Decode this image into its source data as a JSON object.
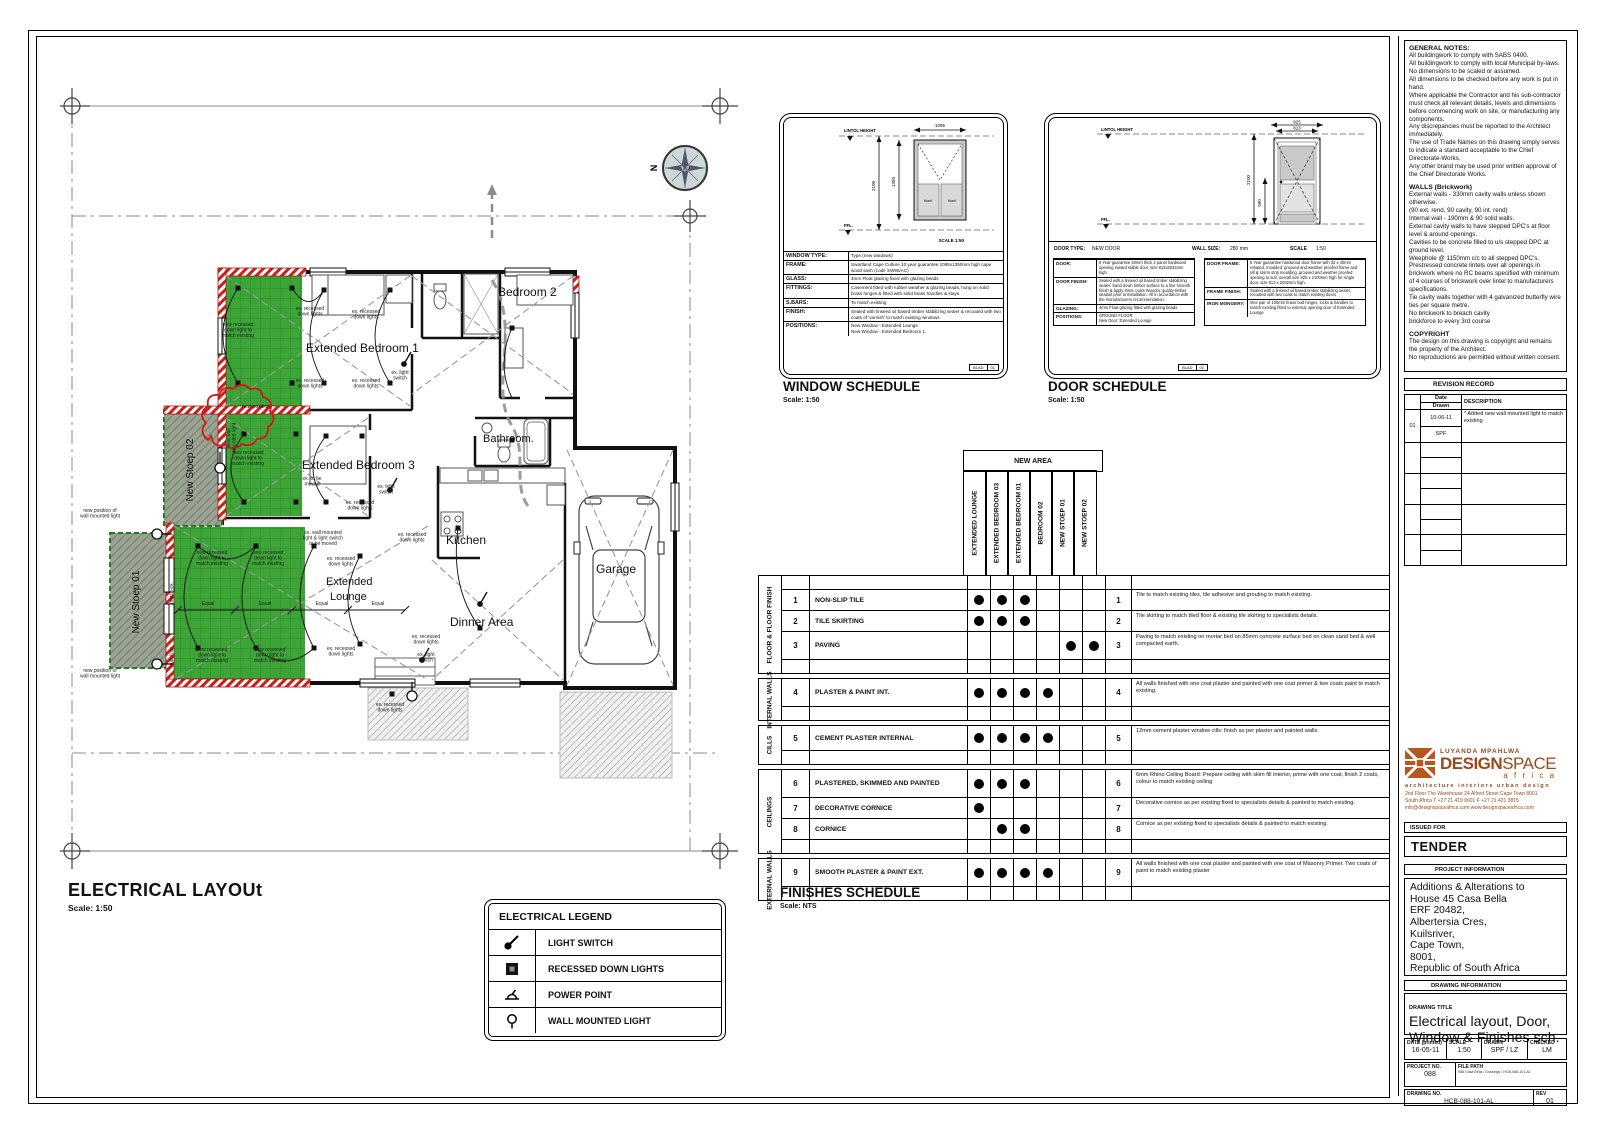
{
  "colors": {
    "accent_green": "#3da438",
    "revision_red": "#d41717",
    "wall_red_hatch": "#c9201d",
    "logo_orange": "#9c4a1a",
    "compass_fill": "#ccd9d8"
  },
  "plan": {
    "title": "ELECTRICAL LAYOUt",
    "scale": "Scale: 1:50",
    "compass_label": "N",
    "rooms": [
      {
        "x": 246,
        "y": 264,
        "t": "Extended Bedroom 1",
        "s": 12
      },
      {
        "x": 438,
        "y": 208,
        "t": "Bedroom 2",
        "s": 12
      },
      {
        "x": 242,
        "y": 381,
        "t": "Extended Bedroom 3",
        "s": 12
      },
      {
        "x": 423,
        "y": 354,
        "t": "Bathroom.",
        "s": 11
      },
      {
        "x": 386,
        "y": 456,
        "t": "Kitchen",
        "s": 12
      },
      {
        "x": 266,
        "y": 497,
        "t": "Extended",
        "s": 11
      },
      {
        "x": 270,
        "y": 512,
        "t": "Lounge",
        "s": 11
      },
      {
        "x": 390,
        "y": 538,
        "t": "Dinner Area",
        "s": 12
      },
      {
        "x": 536,
        "y": 485,
        "t": "Garage",
        "s": 12
      },
      {
        "x": 133,
        "y": 382,
        "t": "New Stoep 02",
        "s": 10,
        "r": -90,
        "a": "middle"
      },
      {
        "x": 79,
        "y": 514,
        "t": "New Stoep 01",
        "s": 10,
        "r": -90,
        "a": "middle"
      }
    ],
    "annotations": [
      {
        "x": 250,
        "y": 222,
        "lines": [
          "ex. recessed",
          "down lights"
        ]
      },
      {
        "x": 306,
        "y": 225,
        "lines": [
          "ex. recessed",
          "down lights"
        ]
      },
      {
        "x": 250,
        "y": 294,
        "lines": [
          "ex. recessed",
          "down lights"
        ]
      },
      {
        "x": 306,
        "y": 294,
        "lines": [
          "ex. recessed",
          "down lights"
        ]
      },
      {
        "x": 340,
        "y": 286,
        "lines": [
          "ex. light",
          "switch"
        ]
      },
      {
        "x": 178,
        "y": 238,
        "lines": [
          "new recessed",
          "down light to",
          "match existing"
        ]
      },
      {
        "x": 188,
        "y": 366,
        "lines": [
          "new recessed",
          "down light to",
          "match existing"
        ]
      },
      {
        "x": 196,
        "y": 320,
        "lines": [
          "new position"
        ]
      },
      {
        "x": 252,
        "y": 392,
        "lines": [
          "ex. to be",
          "moved"
        ]
      },
      {
        "x": 300,
        "y": 416,
        "lines": [
          "ex. recessed",
          "down lights"
        ]
      },
      {
        "x": 326,
        "y": 400,
        "lines": [
          "ex. light",
          "switch"
        ]
      },
      {
        "x": 152,
        "y": 466,
        "lines": [
          "new recessed",
          "down light to",
          "match existing"
        ]
      },
      {
        "x": 208,
        "y": 466,
        "lines": [
          "new recessed",
          "down light to",
          "match existing"
        ]
      },
      {
        "x": 152,
        "y": 563,
        "lines": [
          "new recessed",
          "down light to",
          "match existing"
        ]
      },
      {
        "x": 210,
        "y": 563,
        "lines": [
          "new recessed",
          "down light to",
          "match existing"
        ]
      },
      {
        "x": 281,
        "y": 472,
        "lines": [
          "ex. recessed",
          "down lights"
        ]
      },
      {
        "x": 281,
        "y": 562,
        "lines": [
          "ex. recessed",
          "down lights"
        ]
      },
      {
        "x": 263,
        "y": 446,
        "lines": [
          "ex. wall mounted",
          "light & light switch",
          "to be moved"
        ]
      },
      {
        "x": 40,
        "y": 424,
        "lines": [
          "new position of",
          "wall mounted light"
        ]
      },
      {
        "x": 40,
        "y": 584,
        "lines": [
          "new position of",
          "wall mounted light"
        ]
      },
      {
        "x": 352,
        "y": 448,
        "lines": [
          "ex. recessed",
          "down lights"
        ]
      },
      {
        "x": 366,
        "y": 550,
        "lines": [
          "ex. recessed",
          "down lights"
        ]
      },
      {
        "x": 366,
        "y": 568,
        "lines": [
          "ex. light",
          "switch"
        ]
      },
      {
        "x": 330,
        "y": 618,
        "lines": [
          "ex. recessed",
          "down lights"
        ]
      },
      {
        "x": 170,
        "y": 350,
        "r": -90,
        "lines": [
          "new wall",
          "mounted light"
        ]
      },
      {
        "x": 113,
        "y": 505,
        "r": -90,
        "lines": [
          "match ex."
        ]
      },
      {
        "x": 113,
        "y": 568,
        "r": -90,
        "lines": [
          "match ex."
        ]
      },
      {
        "x": 148,
        "y": 517,
        "lines": [
          "Equal"
        ]
      },
      {
        "x": 205,
        "y": 517,
        "lines": [
          "Equal"
        ]
      },
      {
        "x": 262,
        "y": 517,
        "lines": [
          "Equal"
        ]
      },
      {
        "x": 318,
        "y": 517,
        "lines": [
          "Equal"
        ]
      }
    ]
  },
  "legend": {
    "title": "ELECTRICAL LEGEND",
    "items": [
      {
        "icon": "light-switch-icon",
        "label": "LIGHT SWITCH"
      },
      {
        "icon": "recessed-downlight-icon",
        "label": "RECESSED DOWN LIGHTS"
      },
      {
        "icon": "power-point-icon",
        "label": "POWER POINT"
      },
      {
        "icon": "wall-mounted-light-icon",
        "label": "WALL MOUNTED LIGHT"
      }
    ]
  },
  "window_schedule": {
    "title": "WINDOW SCHEDULE",
    "scale": "Scale: 1:50",
    "lintol": "LINTOL HEIGHT",
    "ffl": "FFL.",
    "scale_inner": "SCALE  1:50",
    "fixed1": "fixed",
    "fixed2": "fixed",
    "dims": {
      "w": "1095",
      "h": "2100",
      "h2": "1350"
    },
    "rows": [
      {
        "label": "WINDOW TYPE:",
        "value": "Type (new windows)"
      },
      {
        "label": "FRAME:",
        "value": "Swartland Cape Culture 10 year guarantee 1095x1350mm high cape wood sash (code SW95/AC)"
      },
      {
        "label": "GLASS:",
        "value": "4mm Float glazing fixed with glazing beads"
      },
      {
        "label": "FITTINGS:",
        "value": "Casement fitted with rubber weather & glazing beads, hung on solid brass hinges & fitted with solid brass handles & stays."
      },
      {
        "label": "S.BARS:",
        "value": "To match existing"
      },
      {
        "label": "FINISH:",
        "value": "Sealed with linseed oil based timber stabilizing sealer & recoated with two coats of 'varnish' to match existing windows"
      },
      {
        "label": "POSITIONS:",
        "value": "New Window - Extended Lounge\nNew Window - Extended Bedroom 1."
      }
    ],
    "ref1": "BLAD",
    "ref2": "01"
  },
  "door_schedule": {
    "title": "DOOR SCHEDULE",
    "scale": "Scale: 1:50",
    "lintol": "LINTOL HEIGHT",
    "ffl": "FFL.",
    "dims": {
      "w1": "925",
      "w2": "813",
      "h": "2100",
      "h2": "990"
    },
    "head": {
      "type_label": "DOOR TYPE:",
      "type_value": "NEW DOOR",
      "wall_label": "WALL SIZE:",
      "wall_value": "280 mm",
      "scale_label": "SCALE",
      "scale_value": "1:50"
    },
    "left_rows": [
      {
        "label": "DOOR:",
        "value": "5 Year guarantee 40mm thick 2 panel hardwood opening inward stable door, size 813x2032mm high."
      },
      {
        "label": "DOOR FINISH:",
        "value": "Sealed with a linseed oil based timber stabilizing sealer. Sand down timber surface to a fine smooth finish & apply three coats Woodoc quality timber sealant prior to installation. All in accordance with the manufacturers recommendation."
      },
      {
        "label": "GLAZING:",
        "value": "4mm Float glazing fitted with glazing beads"
      },
      {
        "label": "POSITIONS:",
        "value": "GROUND FLOOR:\nNew Door: Extended Lounge"
      }
    ],
    "right_rows": [
      {
        "label": "DOOR FRAME:",
        "value": "5 Year guarantee hardwood door frame with 32 x 40mm rebated, moulded, grooved and weather proofed frame and sill & storm strip moulding, grooved and weather proofed opening to suit, overall size 925 x 2100mm high for single door, size 813 x 2032mm high."
      },
      {
        "label": "FRAME FINISH:",
        "value": "Sealed with a linseed oil based timber stabilizing sealer, recoated with two coats to match existing doors"
      },
      {
        "label": "IRON MONGERY:",
        "value": "One pair of 100mm brass butt hinges, locks & handles to match existing fitted to external opening door of Extended Lounge"
      }
    ],
    "ref1": "BLAD",
    "ref2": "01"
  },
  "finishes": {
    "title": "FINISHES SCHEDULE",
    "scale": "Scale: NTS",
    "new_area": "NEW AREA",
    "columns": [
      "EXTENDED LOUNGE",
      "EXTENDED BEDROOM 03",
      "EXTENDED BEDROOM 01",
      "BEDROOM 02",
      "NEW STOEP 01",
      "NEW STOEP 02"
    ],
    "groups": [
      {
        "category": "FLOOR & FLOOR FINISH",
        "spacer_top": true,
        "rows": [
          {
            "num": "1",
            "name": "NON-SLIP TILE",
            "dots": [
              1,
              1,
              1,
              0,
              0,
              0
            ],
            "h": 20,
            "desc": "Tile to match existing tiles, tile adhesive and grouting to match existing."
          },
          {
            "num": "2",
            "name": "TILE SKIRTING",
            "dots": [
              1,
              1,
              1,
              0,
              0,
              0
            ],
            "h": 20,
            "desc": "Tile skirting to match tiled floor & existing tile skirting to specialists details."
          },
          {
            "num": "3",
            "name": "PAVING",
            "dots": [
              0,
              0,
              0,
              0,
              1,
              1
            ],
            "h": 27,
            "desc": "Paving to match existing on mortar bed on 85mm concrete surface bed on clean sand bed & well compacted earth."
          }
        ]
      },
      {
        "category": "INTERNAL WALLS",
        "rows": [
          {
            "num": "4",
            "name": "PLASTER & PAINT  INT.",
            "dots": [
              1,
              1,
              1,
              1,
              0,
              0
            ],
            "h": 27,
            "desc": "All walls finished with one coat plaster and painted with one coat primer & two coats paint to match existing."
          }
        ]
      },
      {
        "category": "CILLS",
        "rows": [
          {
            "num": "5",
            "name": "CEMENT PLASTER INTERNAL",
            "dots": [
              1,
              1,
              1,
              1,
              0,
              0
            ],
            "h": 24,
            "desc": "12mm cement plaster window cills: finish as per plaster and painted walls."
          }
        ]
      },
      {
        "category": "CEILINGS",
        "rows": [
          {
            "num": "6",
            "name": "PLASTERED, SKIMMED AND PAINTED",
            "dots": [
              1,
              1,
              1,
              0,
              0,
              0
            ],
            "h": 27,
            "desc": "6mm Rhino Ceiling Board: Prepare ceiling with skim fill interior, prime with one coat, finish 2 coats, colour to match existing ceiling"
          },
          {
            "num": "7",
            "name": "DECORATIVE CORNICE",
            "dots": [
              1,
              0,
              0,
              0,
              0,
              0
            ],
            "h": 20,
            "desc": "Decorative cornice as per existing fixed to specialists details & painted to match existing."
          },
          {
            "num": "8",
            "name": "CORNICE",
            "dots": [
              0,
              1,
              1,
              0,
              0,
              0
            ],
            "h": 20,
            "desc": "Cornice as per existing fixed to specialists details & painted to match existing."
          }
        ]
      },
      {
        "category": "EXTERNAL WALLS",
        "rows": [
          {
            "num": "9",
            "name": "SMOOTH PLASTER & PAINT EXT.",
            "dots": [
              1,
              1,
              1,
              1,
              0,
              0
            ],
            "h": 27,
            "desc": "All walls finished with one coat plaster and painted with one coat of Masonry Primer. Two coats of paint to match existing plaster"
          }
        ]
      }
    ]
  },
  "notes": {
    "sections": [
      {
        "title": "GENERAL NOTES:",
        "paras": [
          "All buildingwork to comply with SABS 0400.",
          "All buildingwork to comply with local Municipal by-laws.",
          "No dimensions to be scaled or assumed.",
          "All dimensions to be checked before any work is put in hand.",
          "Where applicable the Contractor and his sub-contractor must check all relevant details, levels and dimensions before commencing work on site, or manufacturing any components.",
          "Any discrepancies must be reported to the Architect immediately.",
          "The use of Trade Names on this drawing simply serves to indicate a standard acceptable to the Chief Directorate-Works.",
          "Any other brand may be used prior written approval of the Chief Directorate Works."
        ]
      },
      {
        "title": "WALLS (Brickwork)",
        "paras": [
          "External walls - 330mm cavity walls unless shown otherwise.",
          "(90 ext. rend, 90 cavity, 90 int. rend)",
          "Internal wall - 190mm & 90 solid walls.",
          "External cavity walls to have stepped DPC's at floor level & around openings.",
          "Cavities to be concrete filled to u/s stepped DPC at ground level.",
          "Weephole @ 1150mm c/c to all stepped DPC's.",
          "Prestressed concrete lintels over all openings in brickwork where no RC beams specified with minimum of 4 courses of brickwork over lintel to manufacturers specifications.",
          "Tie cavity walls together with 4 galvanized butterfly wire ties per square metre.",
          "No brickwork to breach cavity",
          "brickforce to every 3rd course"
        ]
      },
      {
        "title": "COPYRIGHT",
        "paras": [
          "The design on this drawing is copyright and remains the property of the Architect.",
          "No reproductions are permitted without written consent."
        ]
      }
    ]
  },
  "revision": {
    "title": "REVISION RECORD",
    "col_date": "Date",
    "col_drawn": "Drawn",
    "col_desc": "DESCRIPTION",
    "rows": [
      {
        "no": "01",
        "date": "10-06-11",
        "drawn": "SPF",
        "desc": "*  Added new wall mounted light to match existing"
      }
    ]
  },
  "firm": {
    "name_top": "LUYANDA MPAHLWA",
    "name_main": "DESIGN",
    "name_main2": "SPACE",
    "name_sub": "a f r i c a",
    "tagline": "architecture  interiors  urban design",
    "addr1": "2nd Floor  The Warehouse  24 Alfred Street  Cape Town 8001",
    "addr2": "South Africa   T +27 21 419 0601   F +27 21 421 3815",
    "addr3": "info@designspaceafrica.com   www.designspaceafrica.com"
  },
  "titleblock": {
    "issued_for_label": "ISSUED FOR",
    "issued_for": "TENDER",
    "project_info_label": "PROJECT INFORMATION",
    "project_lines": [
      "Additions & Alterations to",
      "House 45 Casa Bella",
      "ERF 20482,",
      "Albertersia Cres,",
      "Kuilsriver,",
      "Cape Town,",
      "8001,",
      "Republic of South Africa"
    ],
    "drawing_info_label": "DRAWING INFORMATION",
    "drawing_title_label": "DRAWING TITLE",
    "drawing_title1": "Electrical layout, Door,",
    "drawing_title2": "Window & Finishes sch.",
    "date_label": "DATE (printed)",
    "date": "16-05-11",
    "scale_label": "SCALE",
    "scale": "1:50",
    "drawn_label": "DRAWN",
    "drawn": "SPF / LZ",
    "checked_label": "CHECKED",
    "checked": "LM",
    "project_no_label": "PROJECT NO.",
    "project_no": "088",
    "file_path_label": "FILE PATH",
    "file_path": "088 Casa Bella / Drawings / HCB-088-101-AL",
    "drawing_no_label": "DRAWING NO.",
    "drawing_no": "HCB-088-101-AL",
    "rev_label": "REV",
    "rev": "01"
  }
}
